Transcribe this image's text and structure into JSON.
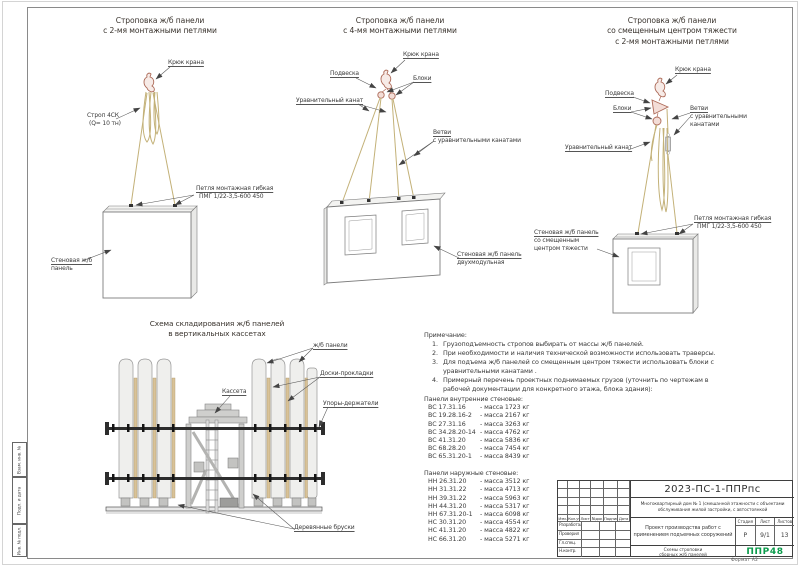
{
  "frame": {
    "format": "Формат  А2",
    "side_labels": [
      "Взам. инв. №",
      "Подп. и дата",
      "Инв. № подл."
    ]
  },
  "d1": {
    "t1": "Строповка ж/б панели",
    "t2": "с 2-мя монтажными петлями",
    "hook": "Крюк крана",
    "sling1": "Строп 4СК",
    "sling2": "(Q= 10 тн)",
    "loop1": "Петля монтажная гибкая",
    "loop2": "ПМГ 1/22-3,5-600 450",
    "panel1": "Стеновая ж/б",
    "panel2": "панель"
  },
  "d2": {
    "t1": "Строповка ж/б панели",
    "t2": "с 4-мя монтажными петлями",
    "hook": "Крюк крана",
    "susp": "Подвеска",
    "blocks": "Блоки",
    "eq": "Уравнительный канат",
    "br1": "Ветви",
    "br2": "с уравнительными канатами",
    "panel1": "Стеновая ж/б панель",
    "panel2": "двухмодульная"
  },
  "d3": {
    "t1": "Строповка ж/б панели",
    "t2": "со смещенным центром тяжести",
    "t3": "с 2-мя монтажными петлями",
    "hook": "Крюк крана",
    "susp": "Подвеска",
    "blocks": "Блоки",
    "br1": "Ветви",
    "br2": "с уравнительными",
    "br3": "канатами",
    "eq": "Уравнительный канат",
    "panel1": "Стеновая ж/б панель",
    "panel2": "со смещенным",
    "panel3": "центром тяжести",
    "loop1": "Петля монтажная гибкая",
    "loop2": "ПМГ 1/22-3,5-600 450"
  },
  "storage": {
    "t1": "Схема складирования ж/б панелей",
    "t2": "в вертикальных кассетах",
    "panels": "ж/б панели",
    "boards": "Доски-прокладки",
    "cassette": "Кассета",
    "stops": "Упоры-держатели",
    "bars": "Деревянные бруски"
  },
  "notes": {
    "heading": "Примечание:",
    "nums": [
      "1.",
      "2.",
      "3.",
      "4."
    ],
    "items": [
      "Грузоподъемность стропов выбирать от массы ж/б панелей.",
      "При необходимости и наличия технической возможности использовать траверсы.",
      "Для подъема ж/б панелей со смещенным центром тяжести использовать блоки с уравнительными канатами .",
      "Примерный перечень проектных поднимаемых грузов (уточнить по чертежам в рабочей документации для конкретного этажа, блока здания):"
    ]
  },
  "inner": {
    "heading": "Панели внутренние стеновые:",
    "rows": [
      {
        "m": "ВС 17.31.16",
        "w": "- масса 1723 кг"
      },
      {
        "m": "ВС 19.28.16-2",
        "w": "- масса 2167 кг"
      },
      {
        "m": "ВС 27.31.16",
        "w": "- масса 3263 кг"
      },
      {
        "m": "ВС 34.28.20-14",
        "w": "- масса 4762 кг"
      },
      {
        "m": "ВС 41.31.20",
        "w": "- масса 5836 кг"
      },
      {
        "m": "ВС 68.28.20",
        "w": "- масса 7454 кг"
      },
      {
        "m": "ВС 65.31.20-1",
        "w": "- масса 8439 кг"
      }
    ]
  },
  "outer": {
    "heading": "Панели наружные стеновые:",
    "rows": [
      {
        "m": "НН 26.31.20",
        "w": "- масса 3512 кг"
      },
      {
        "m": "НН 31.31.22",
        "w": "- масса 4713 кг"
      },
      {
        "m": "НН 39.31.22",
        "w": "- масса 5963 кг"
      },
      {
        "m": "НН 44.31.20",
        "w": "- масса 5317 кг"
      },
      {
        "m": "НН 67.31.20-1",
        "w": "- масса 6098 кг"
      },
      {
        "m": "НС 30.31.20",
        "w": "- масса 4554 кг"
      },
      {
        "m": "НС 41.31.20",
        "w": "- масса 4822 кг"
      },
      {
        "m": "НС 66.31.20",
        "w": "- масса 5271 кг"
      }
    ]
  },
  "tb": {
    "doc": "2023-ПС-1-ППРпс",
    "object1": "Многоквартирный дом № 1 (смешанной этажности с объектами",
    "object2": "обслуживания жилой застройки, с автостоянкой",
    "project1": "Проект производства работ с",
    "project2": "применением подъемных сооружений",
    "stage_l": "Стадия",
    "list_l": "Лист",
    "lists_l": "Листов",
    "stage": "Р",
    "list": "9/1",
    "lists": "13",
    "title1": "Схемы строповки",
    "title2": "сборных ж/б панелей",
    "logo": "ППР48",
    "logo_color": "#0b9b4b",
    "cols": [
      "Изм.",
      "Кол.уч",
      "Лист",
      "№док",
      "Подпись",
      "Дата"
    ],
    "rows": [
      "Разработал",
      "Проверил",
      "Гл.спец.",
      "Н.контр."
    ]
  }
}
